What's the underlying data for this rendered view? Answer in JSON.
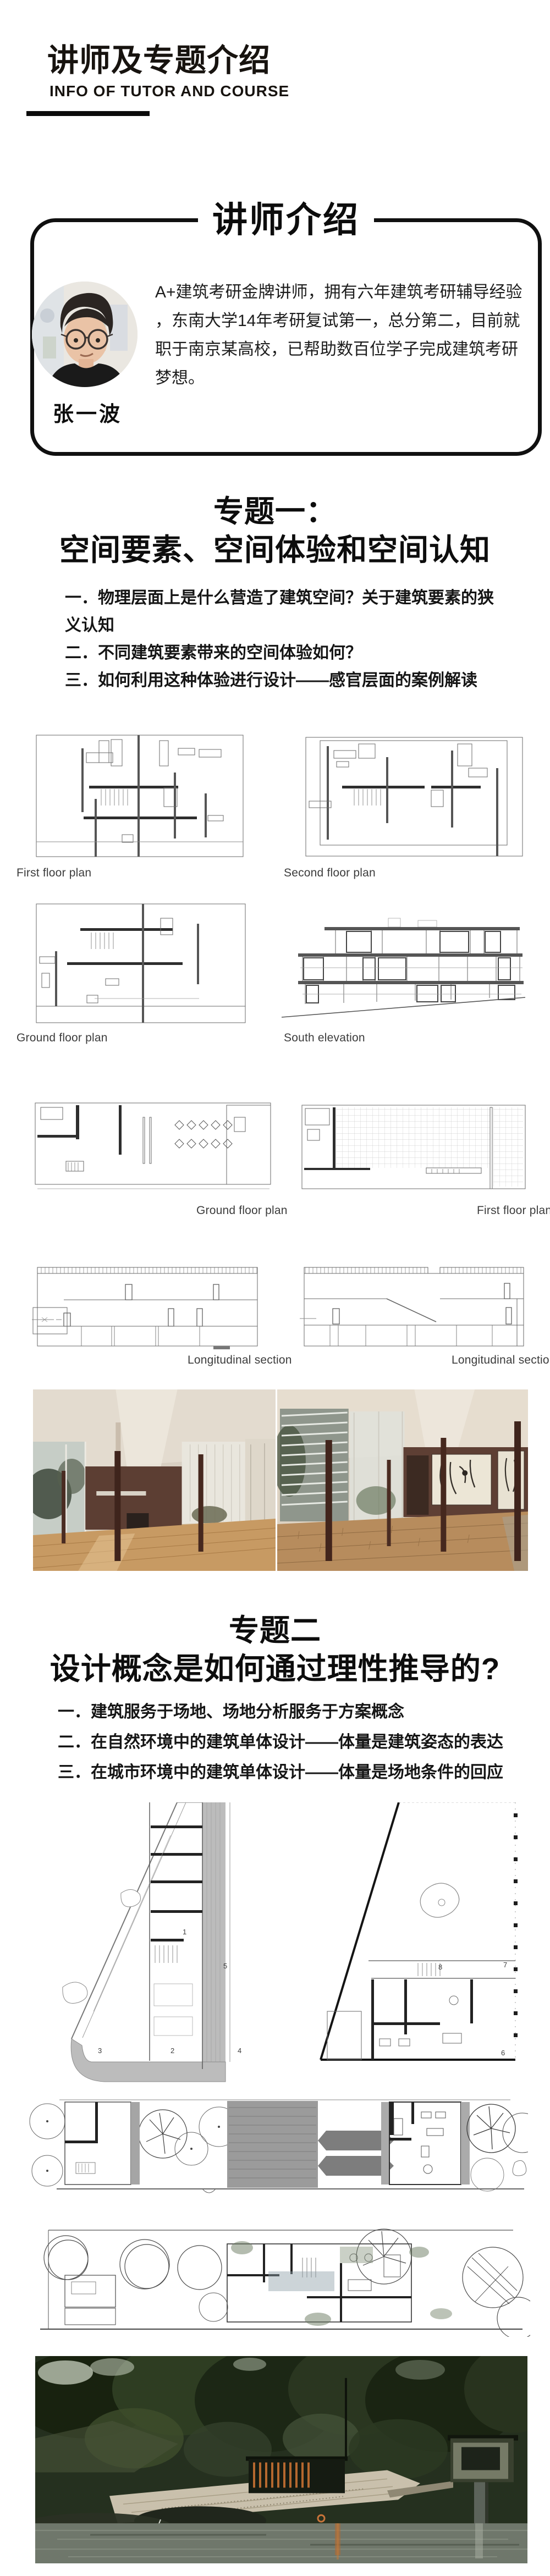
{
  "header": {
    "title": "讲师及专题介绍",
    "subtitle": "INFO OF TUTOR AND COURSE"
  },
  "tutor": {
    "badge": "讲师介绍",
    "name": "张一波",
    "bio_lines": [
      "A+建筑考研金牌讲师，拥有六年建筑考研辅导经验",
      "，东南大学14年考研复试第一，总分第二，目前就",
      "职于南京某高校，已帮助数百位学子完成建筑考研",
      "梦想。"
    ]
  },
  "topic1": {
    "title_line1": "专题一：",
    "title_line2": "空间要素、空间体验和空间认知",
    "items": [
      "一．物理层面上是什么营造了建筑空间？关于建筑要素的狭义认知",
      "二．不同建筑要素带来的空间体验如何？",
      "三．如何利用这种体验进行设计——感官层面的案例解读"
    ]
  },
  "figures": {
    "row1_left": "First floor plan",
    "row1_right": "Second floor plan",
    "row2_left": "Ground floor plan",
    "row2_right": "South elevation",
    "row3_left": "Ground floor plan",
    "row3_right": "First floor plan",
    "row4_left": "Longitudinal section",
    "row4_right": "Longitudinal section"
  },
  "plan_labels": {
    "t1": [
      "1",
      "2",
      "3",
      "4",
      "5"
    ],
    "t2": [
      "6",
      "7",
      "8"
    ]
  },
  "topic2": {
    "title_line1": "专题二",
    "title_line2": "设计概念是如何通过理性推导的?",
    "items": [
      "一．建筑服务于场地、场地分析服务于方案概念",
      "二．在自然环境中的建筑单体设计——体量是建筑姿态的表达",
      "三．在城市环境中的建筑单体设计——体量是场地条件的回应"
    ]
  },
  "colors": {
    "ink": "#111111",
    "caption": "#3c3c3c"
  }
}
